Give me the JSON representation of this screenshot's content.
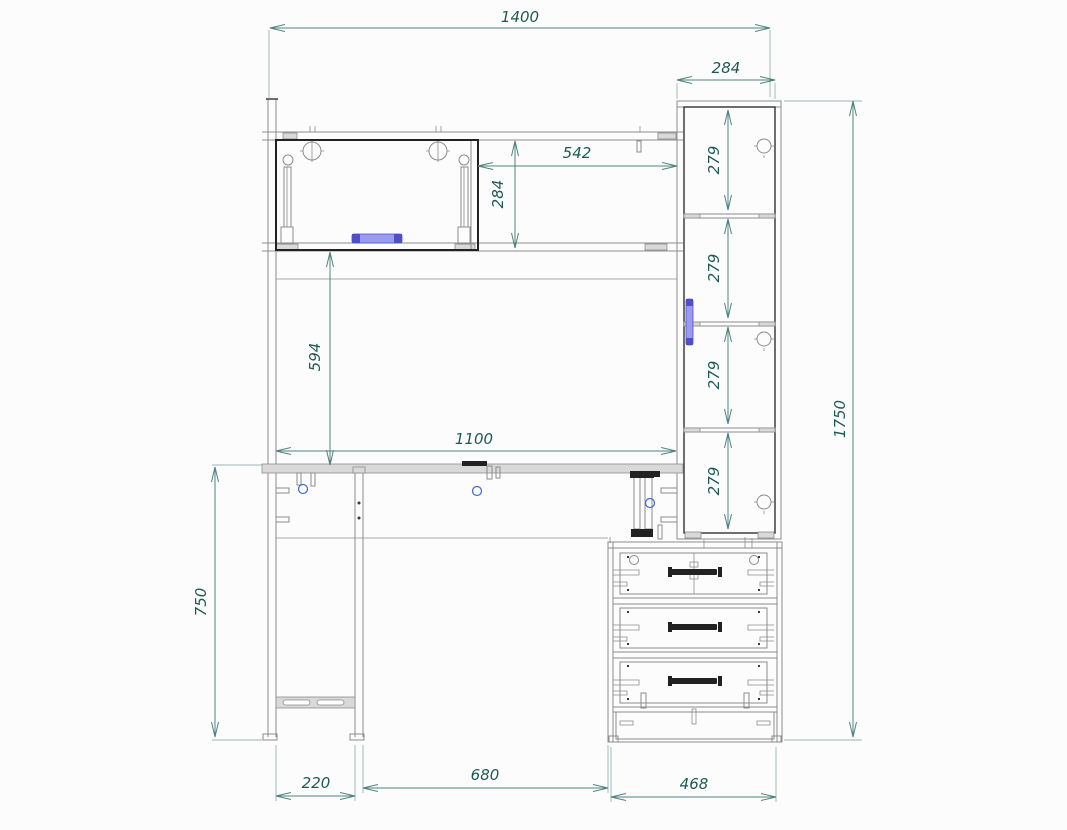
{
  "drawing": {
    "title": "desk-with-hutch-assembly-drawing",
    "units": "mm",
    "dims": {
      "total_width": "1400",
      "side_cabinet_width": "284",
      "niche_width": "542",
      "niche_height": "284",
      "side_cabinet_sections": [
        "279",
        "279",
        "279",
        "279"
      ],
      "hutch_to_desktop": "594",
      "desktop_span": "1100",
      "total_height": "1750",
      "desk_height": "750",
      "leg_gap": "220",
      "knee_space": "680",
      "drawer_unit_width": "468"
    }
  },
  "colors": {
    "background": "#fcfcfc",
    "outline": "#8c8c8c",
    "outline_dark": "#222222",
    "panel_fill": "#d9d9d9",
    "dimension_line": "#4e837e",
    "dimension_text": "#1e5a55",
    "handle_fill": "#9a9af0",
    "handle_cap": "#4f4fc8",
    "hardware_accent": "#3b6bd6"
  }
}
